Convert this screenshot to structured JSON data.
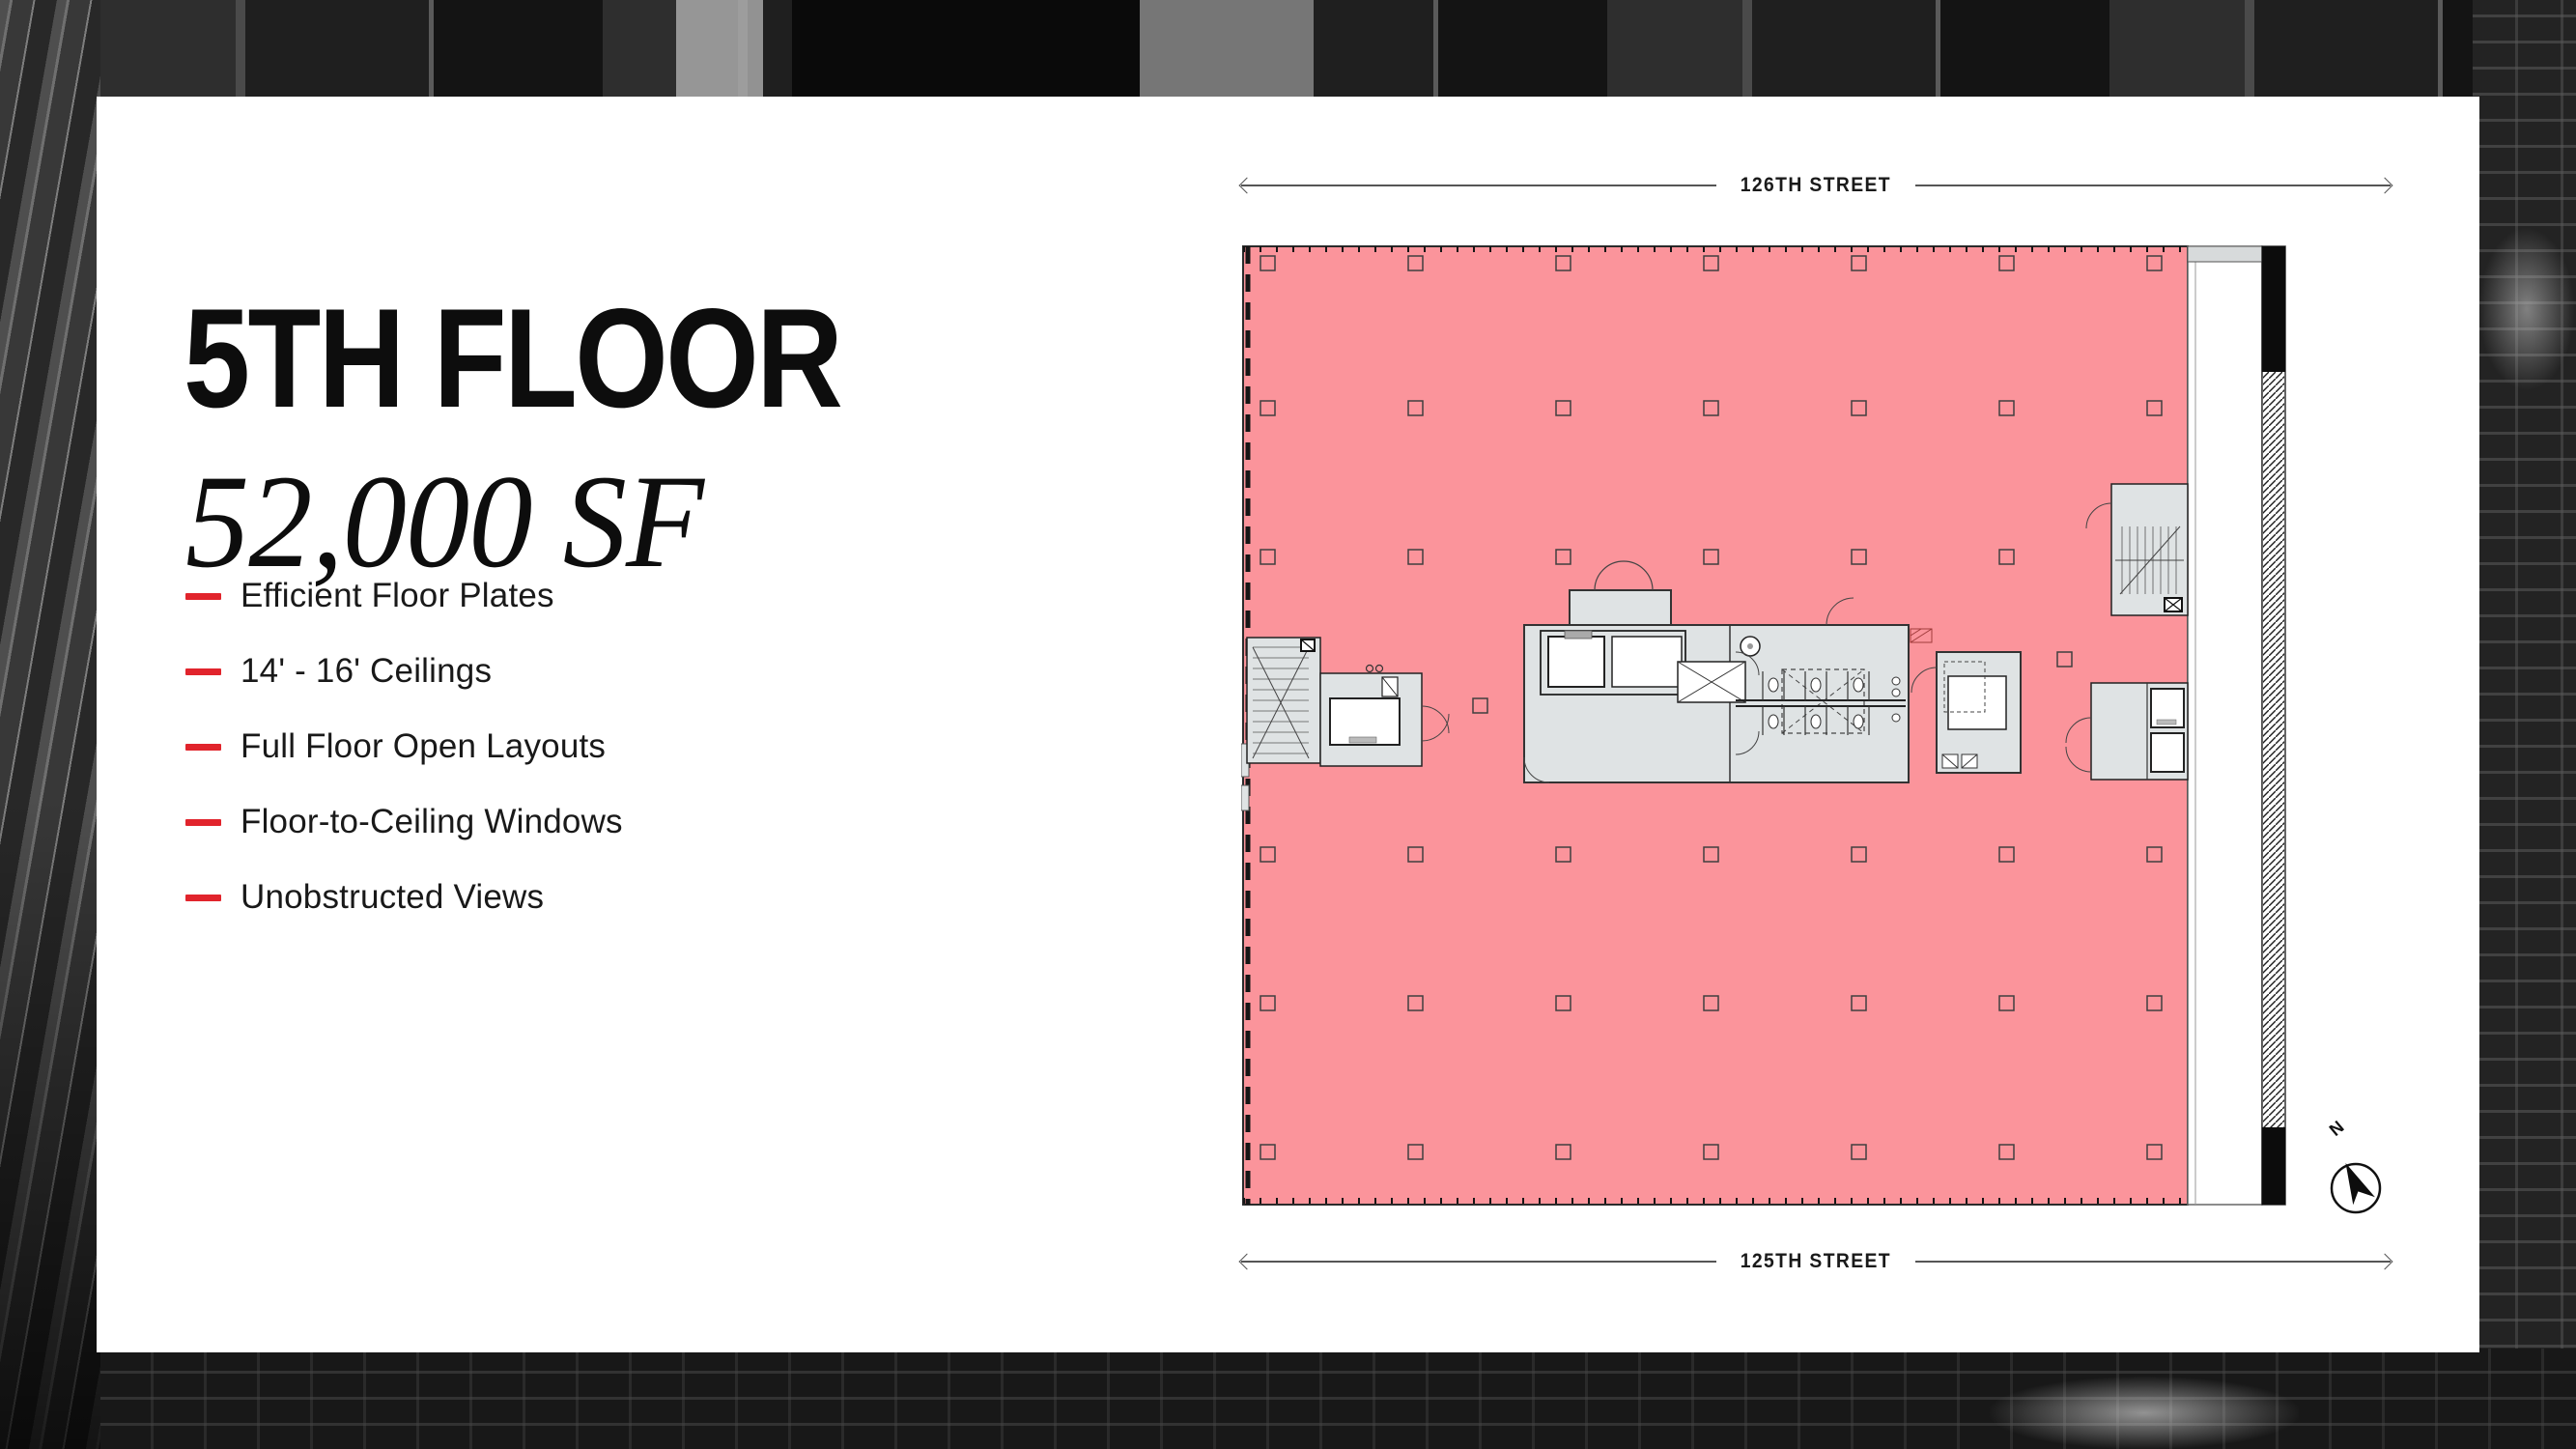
{
  "panel": {
    "title": "5TH FLOOR",
    "subtitle": "52,000 SF",
    "accent_color": "#E1242C",
    "features": [
      {
        "label": "Efficient Floor Plates"
      },
      {
        "label": "14' - 16' Ceilings"
      },
      {
        "label": "Full Floor Open Layouts"
      },
      {
        "label": "Floor-to-Ceiling Windows"
      },
      {
        "label": "Unobstructed Views"
      }
    ]
  },
  "floor_plan": {
    "street_top": "126TH STREET",
    "street_bottom": "125TH STREET",
    "compass_label": "N",
    "colors": {
      "highlight": "#FB949B",
      "core": "#DFE3E4",
      "outline": "#2B2B2B"
    }
  }
}
